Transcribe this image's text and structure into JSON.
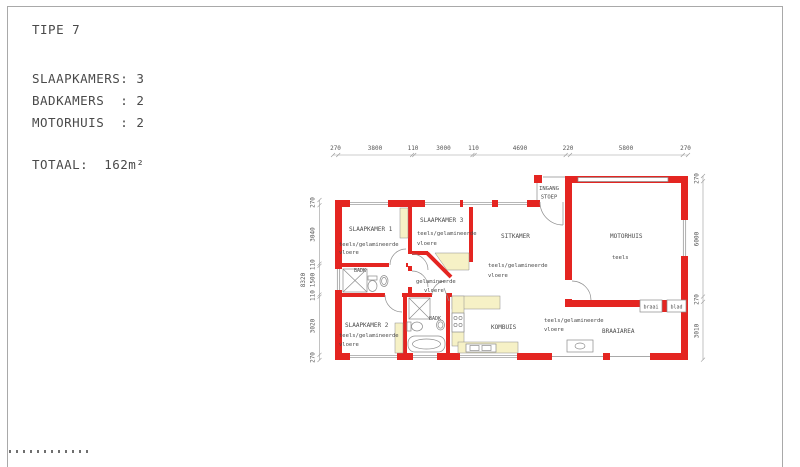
{
  "info": {
    "title": "TIPE 7",
    "bedrooms": "SLAAPKAMERS: 3",
    "bathrooms": "BADKAMERS  : 2",
    "garages": "MOTORHUIS  : 2",
    "total": "TOTAAL:  162m²"
  },
  "dims": {
    "top": [
      "270",
      "3800",
      "110",
      "3000",
      "110",
      "4690",
      "220",
      "5800",
      "270"
    ],
    "left": [
      "270",
      "3040",
      "110",
      "1500",
      "110",
      "3020",
      "270"
    ],
    "left_overall": "8320",
    "right": [
      "270",
      "6000",
      "270",
      "3010"
    ]
  },
  "rooms": {
    "slaapkamer1": {
      "name": "SLAAPKAMER 1",
      "floor1": "teels/gelamineerde",
      "floor2": "vloere"
    },
    "slaapkamer2": {
      "name": "SLAAPKAMER 2",
      "floor1": "teels/gelamineerde",
      "floor2": "vloere"
    },
    "slaapkamer3": {
      "name": "SLAAPKAMER 3",
      "floor1": "teels/gelamineerde",
      "floor2": "vloere"
    },
    "sitkamer": {
      "name": "SITKAMER",
      "floor1": "teels/gelamineerde",
      "floor2": "vloere"
    },
    "motorhuis": {
      "name": "MOTORHUIS",
      "floor": "teels"
    },
    "kombuis": {
      "name": "KOMBUIS"
    },
    "braaiarea": {
      "name": "BRAAIAREA",
      "floor1": "teels/gelamineerde",
      "floor2": "vloere"
    },
    "gang": {
      "floor1": "gelamineerde",
      "floor2": "vloere"
    },
    "badkamer1": {
      "label": "BADK"
    },
    "badkamer2": {
      "label": "BADK"
    },
    "ingang": {
      "line1": "INGANG",
      "line2": "STOEP"
    }
  },
  "features": {
    "braai": "braai",
    "blad": "blad"
  },
  "colors": {
    "wall_red": "#e42521",
    "cupboard_yellow": "#f6f1c6",
    "line_gray": "#8c8c8c",
    "text_gray": "#4a4a4a"
  }
}
